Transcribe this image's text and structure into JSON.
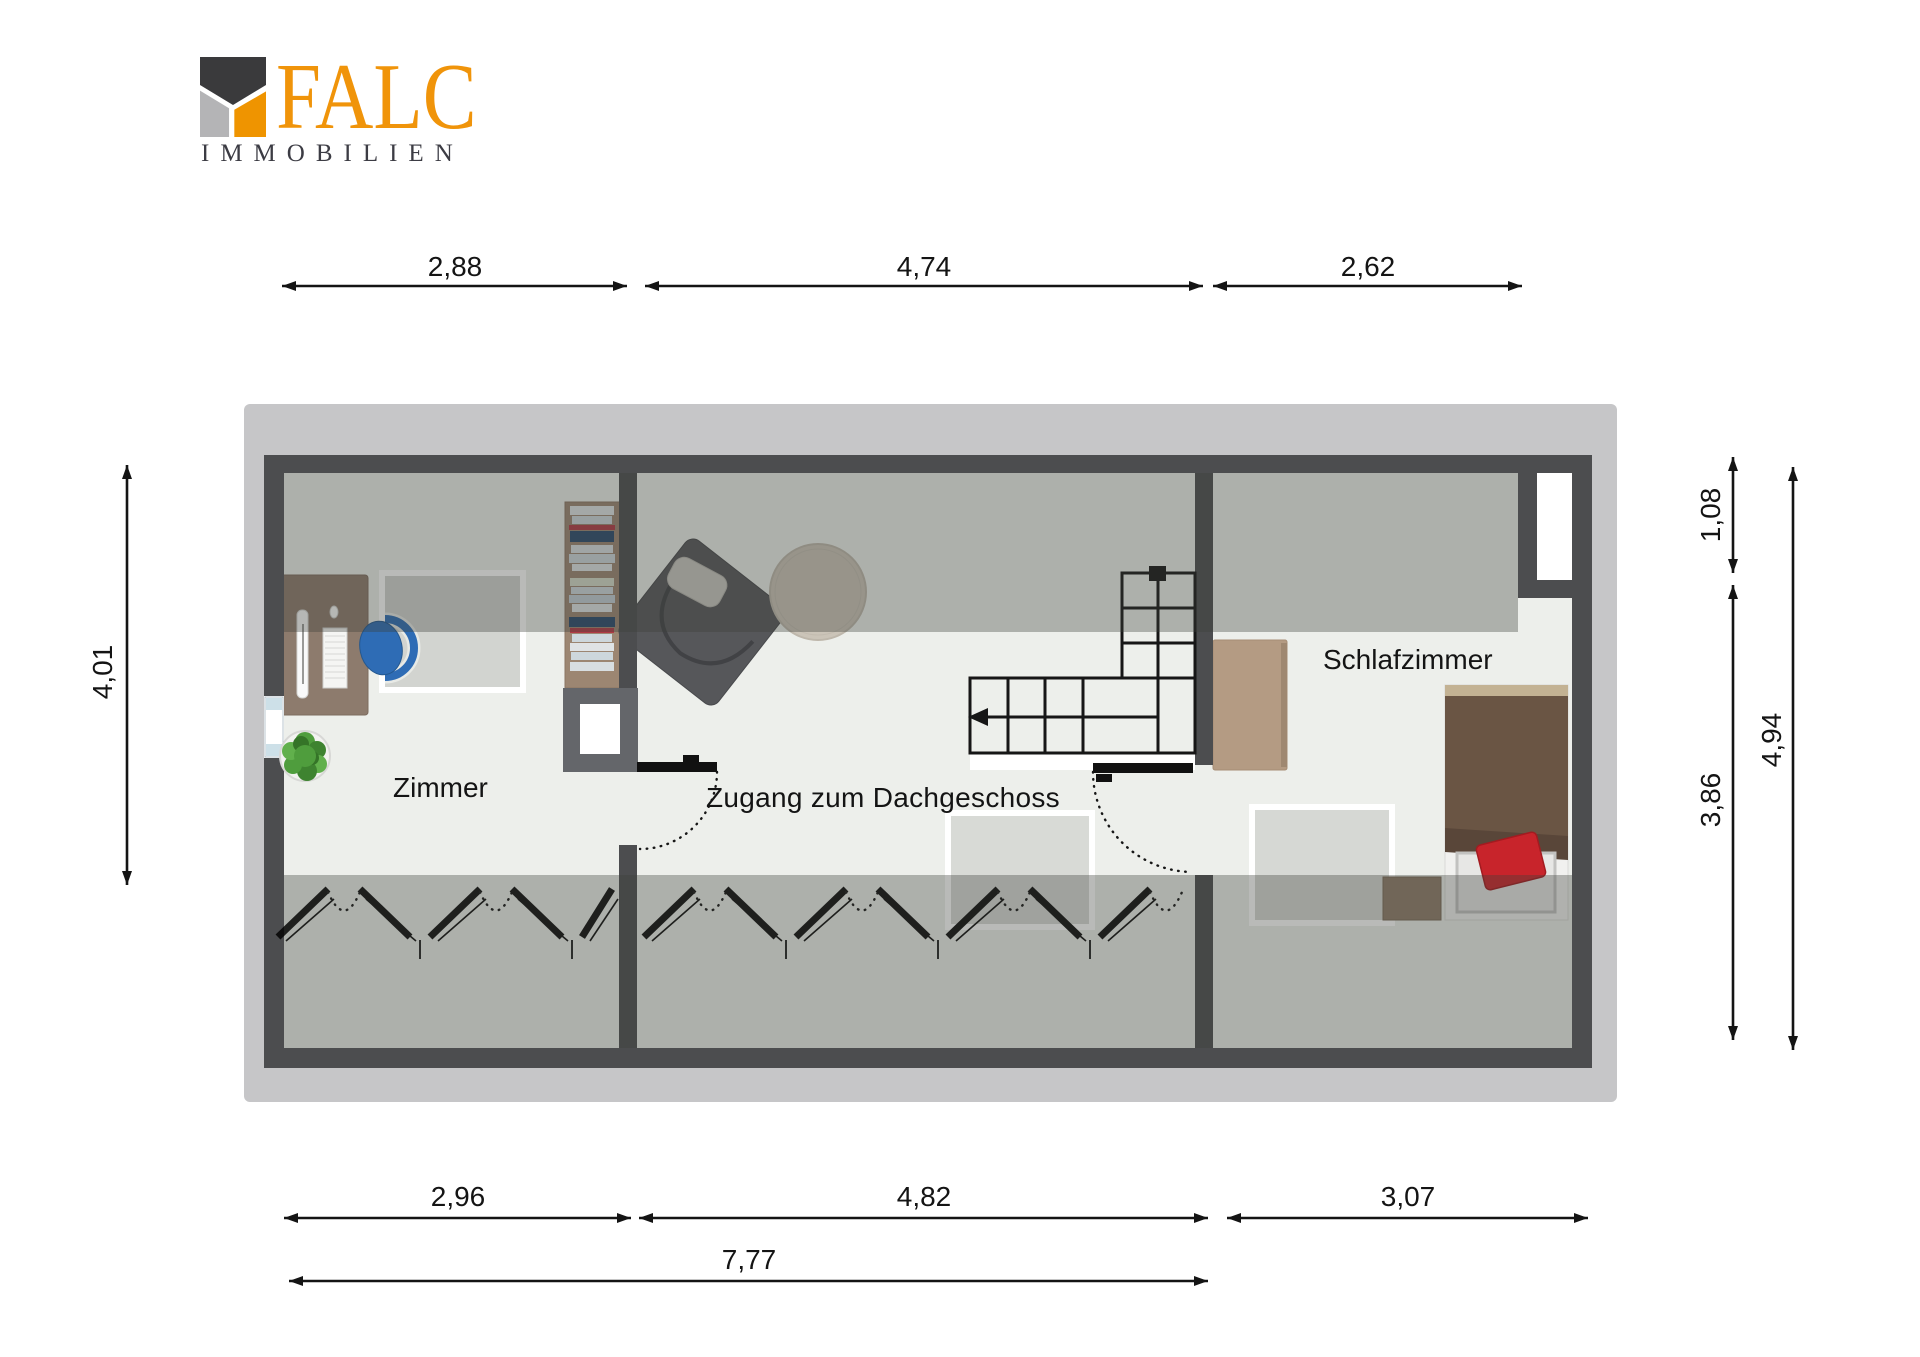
{
  "logo": {
    "brand": "FALC",
    "subtitle": "IMMOBILIEN"
  },
  "room_labels": {
    "zimmer": "Zimmer",
    "zugang": "Zugang zum Dachgeschoss",
    "schlafzimmer": "Schlafzimmer"
  },
  "dimensions": {
    "top": [
      "2,88",
      "4,74",
      "2,62"
    ],
    "bottom": [
      "2,96",
      "4,82",
      "3,07"
    ],
    "total_width": "7,77",
    "left": [
      "4,01"
    ],
    "right": [
      "1,08",
      "3,86",
      "4,94"
    ]
  },
  "colors": {
    "logo_orange": "#ef9400",
    "logo_dark": "#3a3a3c",
    "logo_gray": "#b4b4b6",
    "wall": "#4c4d4f",
    "roof_backdrop": "#c6c6c8",
    "floor": "#edefeb",
    "sloped_zone_overlay": "rgba(60,64,58,0.36)",
    "wood_desk": "#8d7b6d",
    "wood_shelf": "#9c8672",
    "wood_cabinet": "#b49b83",
    "bed_brown": "#6a5544",
    "pillow_red": "#c8242b",
    "chair_blue": "#2e6cb5",
    "plant_green": "#4f9d3d"
  }
}
